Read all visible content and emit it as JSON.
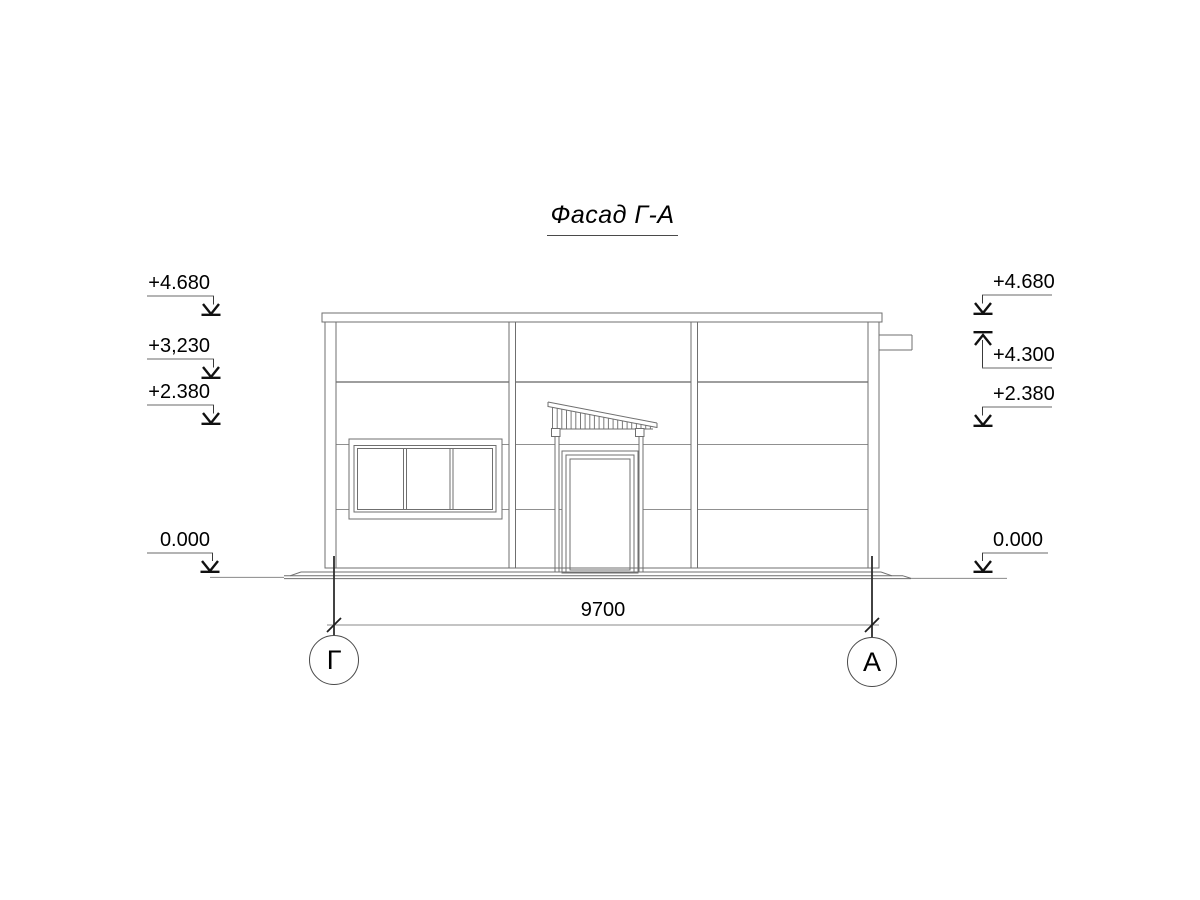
{
  "drawing": {
    "title": "Фасад Г-А"
  },
  "elevation_marks": {
    "left": [
      {
        "label": "+4.680"
      },
      {
        "label": "+3,230"
      },
      {
        "label": "+2.380"
      },
      {
        "label": "0.000"
      }
    ],
    "right": [
      {
        "label": "+4.680"
      },
      {
        "label": "+4.300"
      },
      {
        "label": "+2.380"
      },
      {
        "label": "0.000"
      }
    ]
  },
  "dimension": {
    "value": "9700"
  },
  "axes": [
    {
      "label": "Г"
    },
    {
      "label": "А"
    }
  ],
  "colors": {
    "background": "#ffffff",
    "line": "#6f6f6f",
    "line_light": "#909090",
    "text": "#000000",
    "marker": "#111111"
  }
}
